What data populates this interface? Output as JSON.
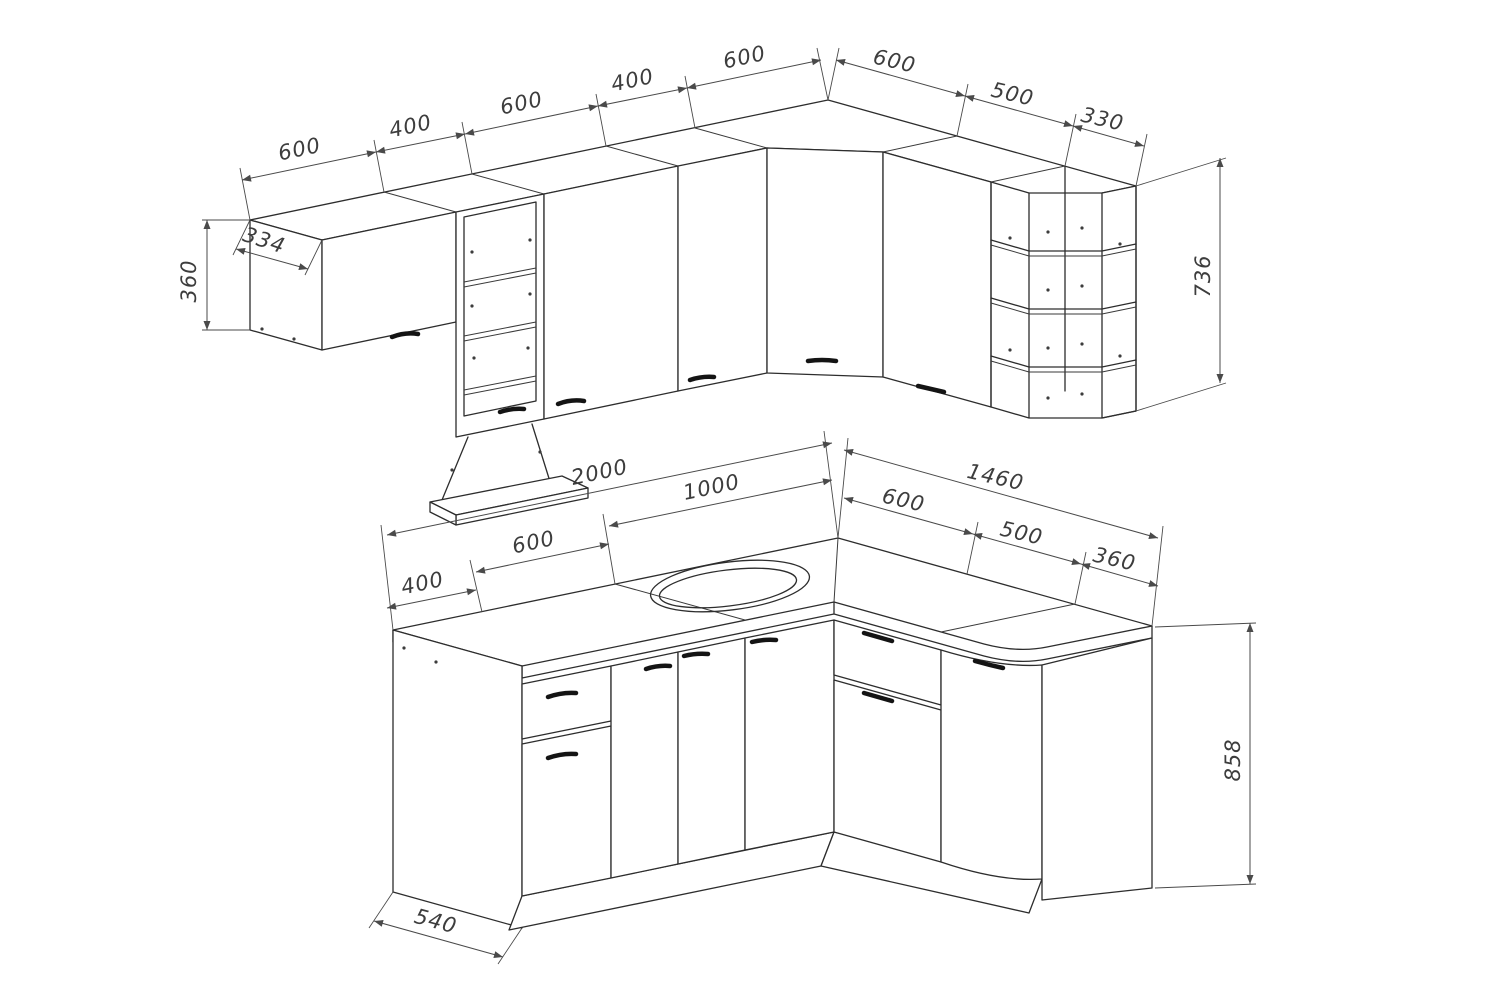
{
  "drawing": {
    "kind": "kitchen-corner-cabinet-set-technical-drawing",
    "background_color": "#ffffff",
    "line_color": "#2d2d2d",
    "dimension_color": "#4a4a4a",
    "handle_color": "#141414"
  },
  "dims": {
    "upper_left": [
      "600",
      "400",
      "600",
      "400",
      "600"
    ],
    "upper_right": [
      "600",
      "500",
      "330"
    ],
    "upper_cabinet_height": "360",
    "upper_depth": "334",
    "upper_tall_height": "736",
    "lower_left": [
      "400",
      "600",
      "1000",
      "2000"
    ],
    "lower_right": [
      "600",
      "500",
      "360",
      "1460"
    ],
    "lower_height": "858",
    "lower_depth": "540"
  }
}
